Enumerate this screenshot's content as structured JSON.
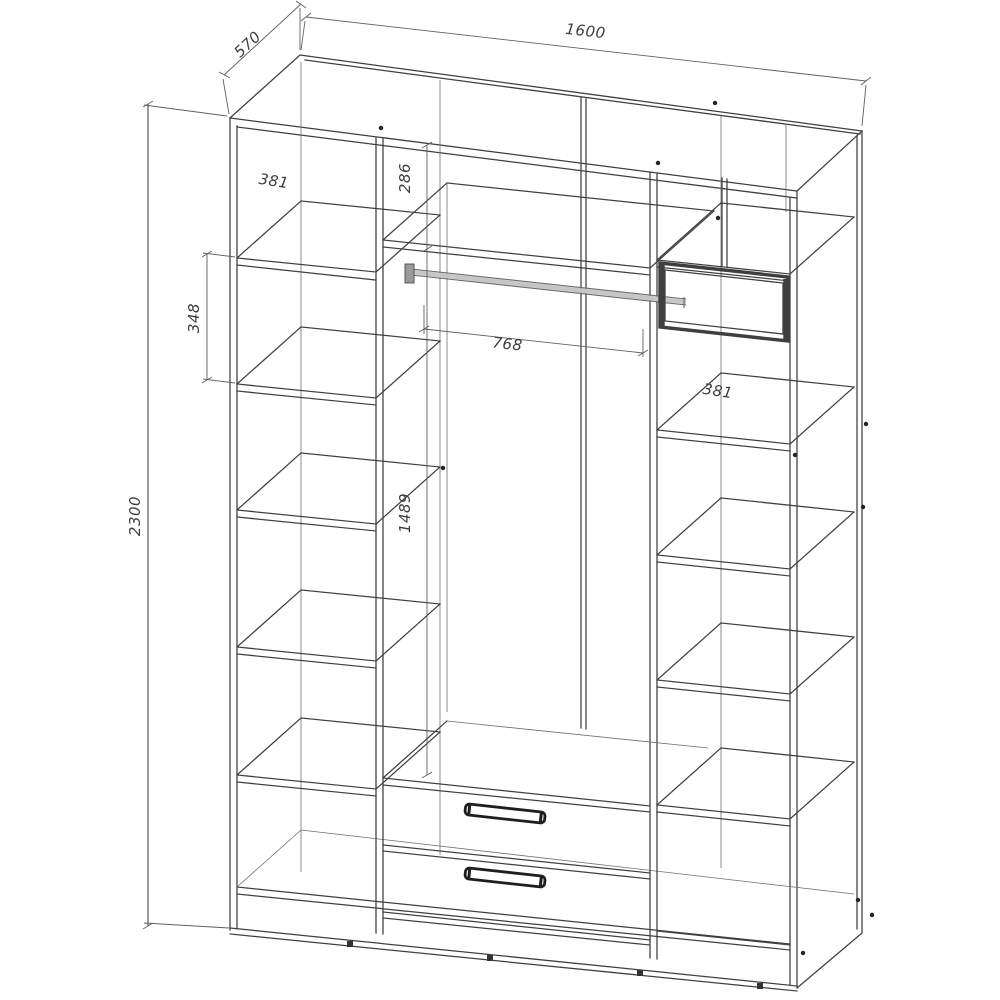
{
  "drawing": {
    "type": "wardrobe-technical-drawing",
    "dimensions": {
      "overall_width": "1600",
      "overall_depth": "570",
      "overall_height": "2300",
      "left_section_shelf_width": "381",
      "left_section_shelf_pitch": "348",
      "top_shelf_drop": "286",
      "middle_section_width": "768",
      "hanging_space_height": "1489",
      "right_section_shelf_width": "381"
    },
    "colors": {
      "bg": "#ffffff",
      "line": "#3f3f3f",
      "lineLight": "#6f6f6f",
      "dim": "#606060",
      "rod": "#c6c6c6",
      "text": "#3d3d3d"
    }
  }
}
